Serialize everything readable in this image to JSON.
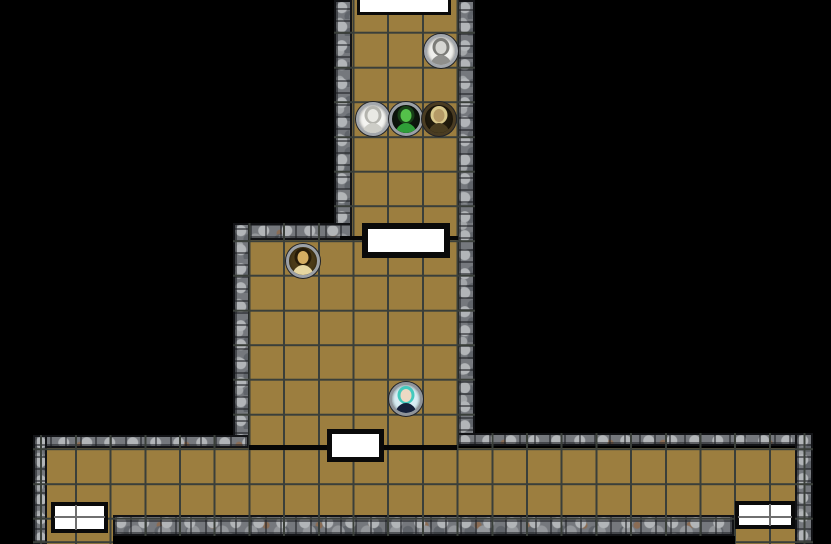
{
  "app": {
    "type": "virtual-tabletop-map-view",
    "visible_text": "none"
  },
  "palette": {
    "bg": "#000000",
    "floor": "#9c7e3f",
    "grid": "#3a3f3a",
    "wall": "#75787d",
    "line": "#060606",
    "door-fill": "#ffffff",
    "door-border": "#0a0a0a"
  },
  "map": {
    "description": "Top-down dungeon battle map with gray cobblestone walls and tan square-grid floors: a north corridor leads down to a central room, which opens south onto a long east-west corridor with exits at its southwest and southeast ends.",
    "grid": {
      "cell_px": 34.7,
      "color": "#3a3f3a"
    },
    "areas": [
      {
        "name": "north-corridor"
      },
      {
        "name": "central-room"
      },
      {
        "name": "south-corridor"
      },
      {
        "name": "southwest-exit"
      },
      {
        "name": "southeast-exit"
      }
    ],
    "doors": [
      {
        "name": "north-corridor-door",
        "style": "white rectangle, black frame, partly off-screen at top edge"
      },
      {
        "name": "central-room-north-door",
        "style": "white rectangle, thick black frame, between north corridor and central room"
      },
      {
        "name": "central-room-south-door",
        "style": "white rectangle, thick black frame, between central room and south corridor"
      },
      {
        "name": "southwest-double-door",
        "style": "white double door with center divider, south wall of corridor, west end"
      },
      {
        "name": "southeast-double-door",
        "style": "white double door with center divider, south wall of corridor, east end"
      }
    ],
    "tokens": [
      {
        "name": "token-engraved-portrait-man",
        "description": "black-and-white engraved portrait of a long-haired man on a white field, stone ring",
        "ring": "#a3a7ac",
        "background": "#efefec",
        "skin": "#d6d6d2",
        "clothing": "#8f8f8c",
        "hair": "#7c7c78"
      },
      {
        "name": "token-sketch-portrait-man",
        "description": "light pencil-sketch portrait of a man's face on a white field, stone ring",
        "ring": "#a3a7ac",
        "background": "#f4f4f1",
        "skin": "#e9e9e4",
        "clothing": "#cdcdc7",
        "hair": "#b4b4ae"
      },
      {
        "name": "token-green-figure",
        "description": "green-skinned man in a green suit on a dark field, stone ring",
        "ring": "#9ba0a6",
        "background": "#0d150c",
        "skin": "#54c14a",
        "clothing": "#2f9e38",
        "hair": "#173f17"
      },
      {
        "name": "token-gold-headdress-figure",
        "description": "gold-toned bust with pale headdress on a dark olive field, dark gold ring",
        "ring": "#4a3c22",
        "background": "#201a0c",
        "skin": "#b59a66",
        "clothing": "#4a3d20",
        "hair": "#d8c88c"
      },
      {
        "name": "token-sepia-woman",
        "description": "sepia portrait of a woman with long dark hair looking down, stone ring",
        "ring": "#9ba0a6",
        "background": "#4a3a18",
        "skin": "#d4ad62",
        "clothing": "#e6d6a0",
        "hair": "#261b08"
      },
      {
        "name": "token-teal-haired-figure",
        "description": "figure with teal hair and dark navy clothes on a pale blue field, stone ring",
        "ring": "#8f949a",
        "background": "#d8edf4",
        "skin": "#ecd9c4",
        "clothing": "#15203a",
        "hair": "#43c9bd"
      }
    ]
  }
}
